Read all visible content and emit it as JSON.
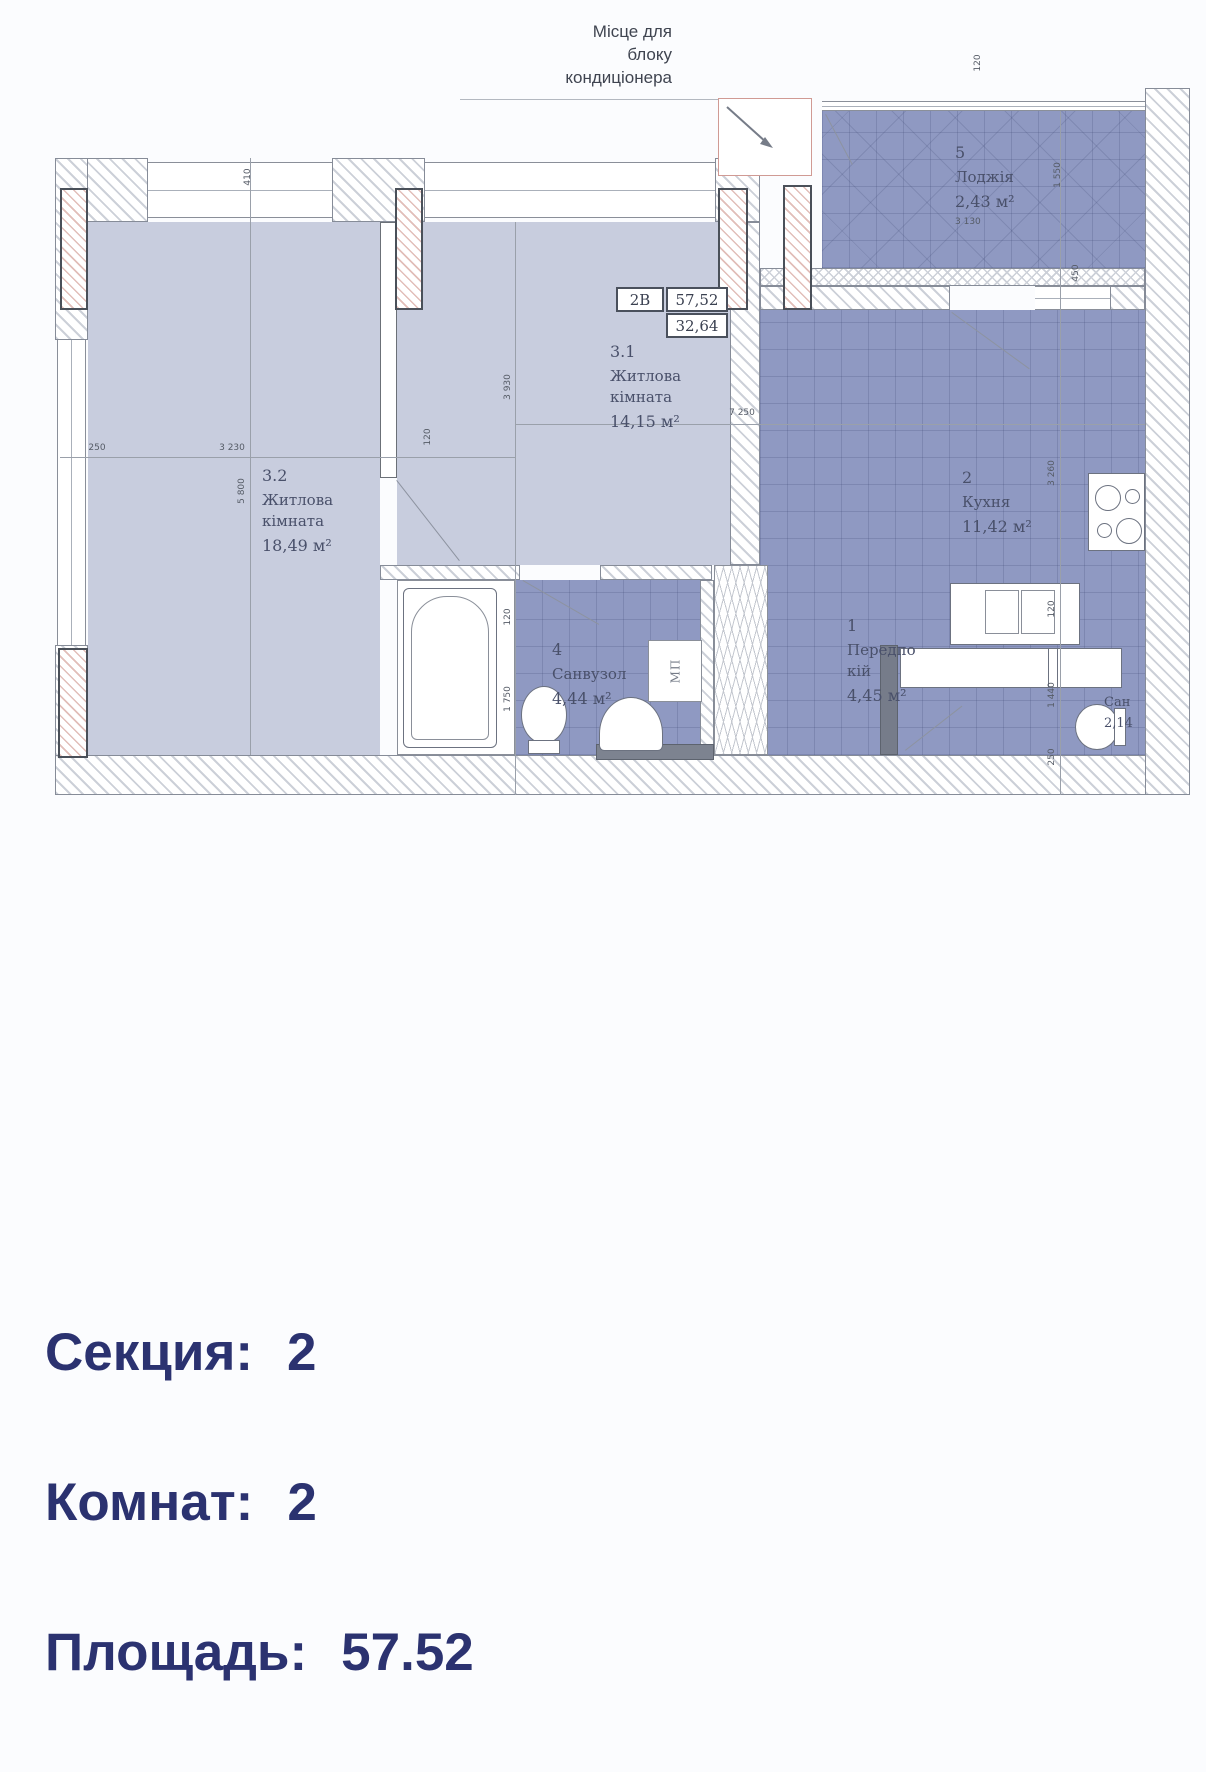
{
  "plan": {
    "annotation": [
      "Місце для",
      "блоку",
      "кондиціонера"
    ],
    "unit_table": {
      "unit": "2В",
      "area_total": "57,52",
      "area_living": "32,64"
    },
    "rooms": {
      "r32": {
        "number": "3.2",
        "name1": "Житлова",
        "name2": "кімната",
        "area": "18,49 м²"
      },
      "r31": {
        "number": "3.1",
        "name1": "Житлова",
        "name2": "кімната",
        "area": "14,15 м²"
      },
      "kitchen": {
        "number": "2",
        "name1": "Кухня",
        "area": "11,42 м²"
      },
      "hall": {
        "number": "1",
        "name1": "Передпо",
        "name2": "кій",
        "area": "4,45 м²"
      },
      "bath": {
        "number": "4",
        "name1": "Санвузол",
        "area": "4,44 м²"
      },
      "loggia": {
        "number": "5",
        "name1": "Лоджія",
        "area": "2,43 м²",
        "dim": "3 130"
      },
      "wc": {
        "name1": "Сан",
        "area": "2,14"
      }
    },
    "fixtures": {
      "washing_machine": "МП"
    },
    "dims": {
      "left_offset": "250",
      "r32_width": "3 230",
      "wall_120": "120",
      "right_span": "7 250",
      "r32_height": "5 800",
      "r31_height": "3 930",
      "window_410": "410",
      "loggia_height": "1 550",
      "loggia_120": "120",
      "door_450": "450",
      "kitchen_height": "3 260",
      "k_120": "120",
      "wc_len": "1 440",
      "wc_250": "250",
      "bath_120": "120",
      "bath_len": "1 750"
    }
  },
  "summary": {
    "rows": [
      {
        "label": "Секция:",
        "value": "2"
      },
      {
        "label": "Комнат:",
        "value": "2"
      },
      {
        "label": "Площадь:",
        "value": "57.52"
      }
    ]
  },
  "colors": {
    "accent_text": "#2b3270",
    "room_light": "#c8cdde",
    "room_dark": "#8f99c2"
  }
}
